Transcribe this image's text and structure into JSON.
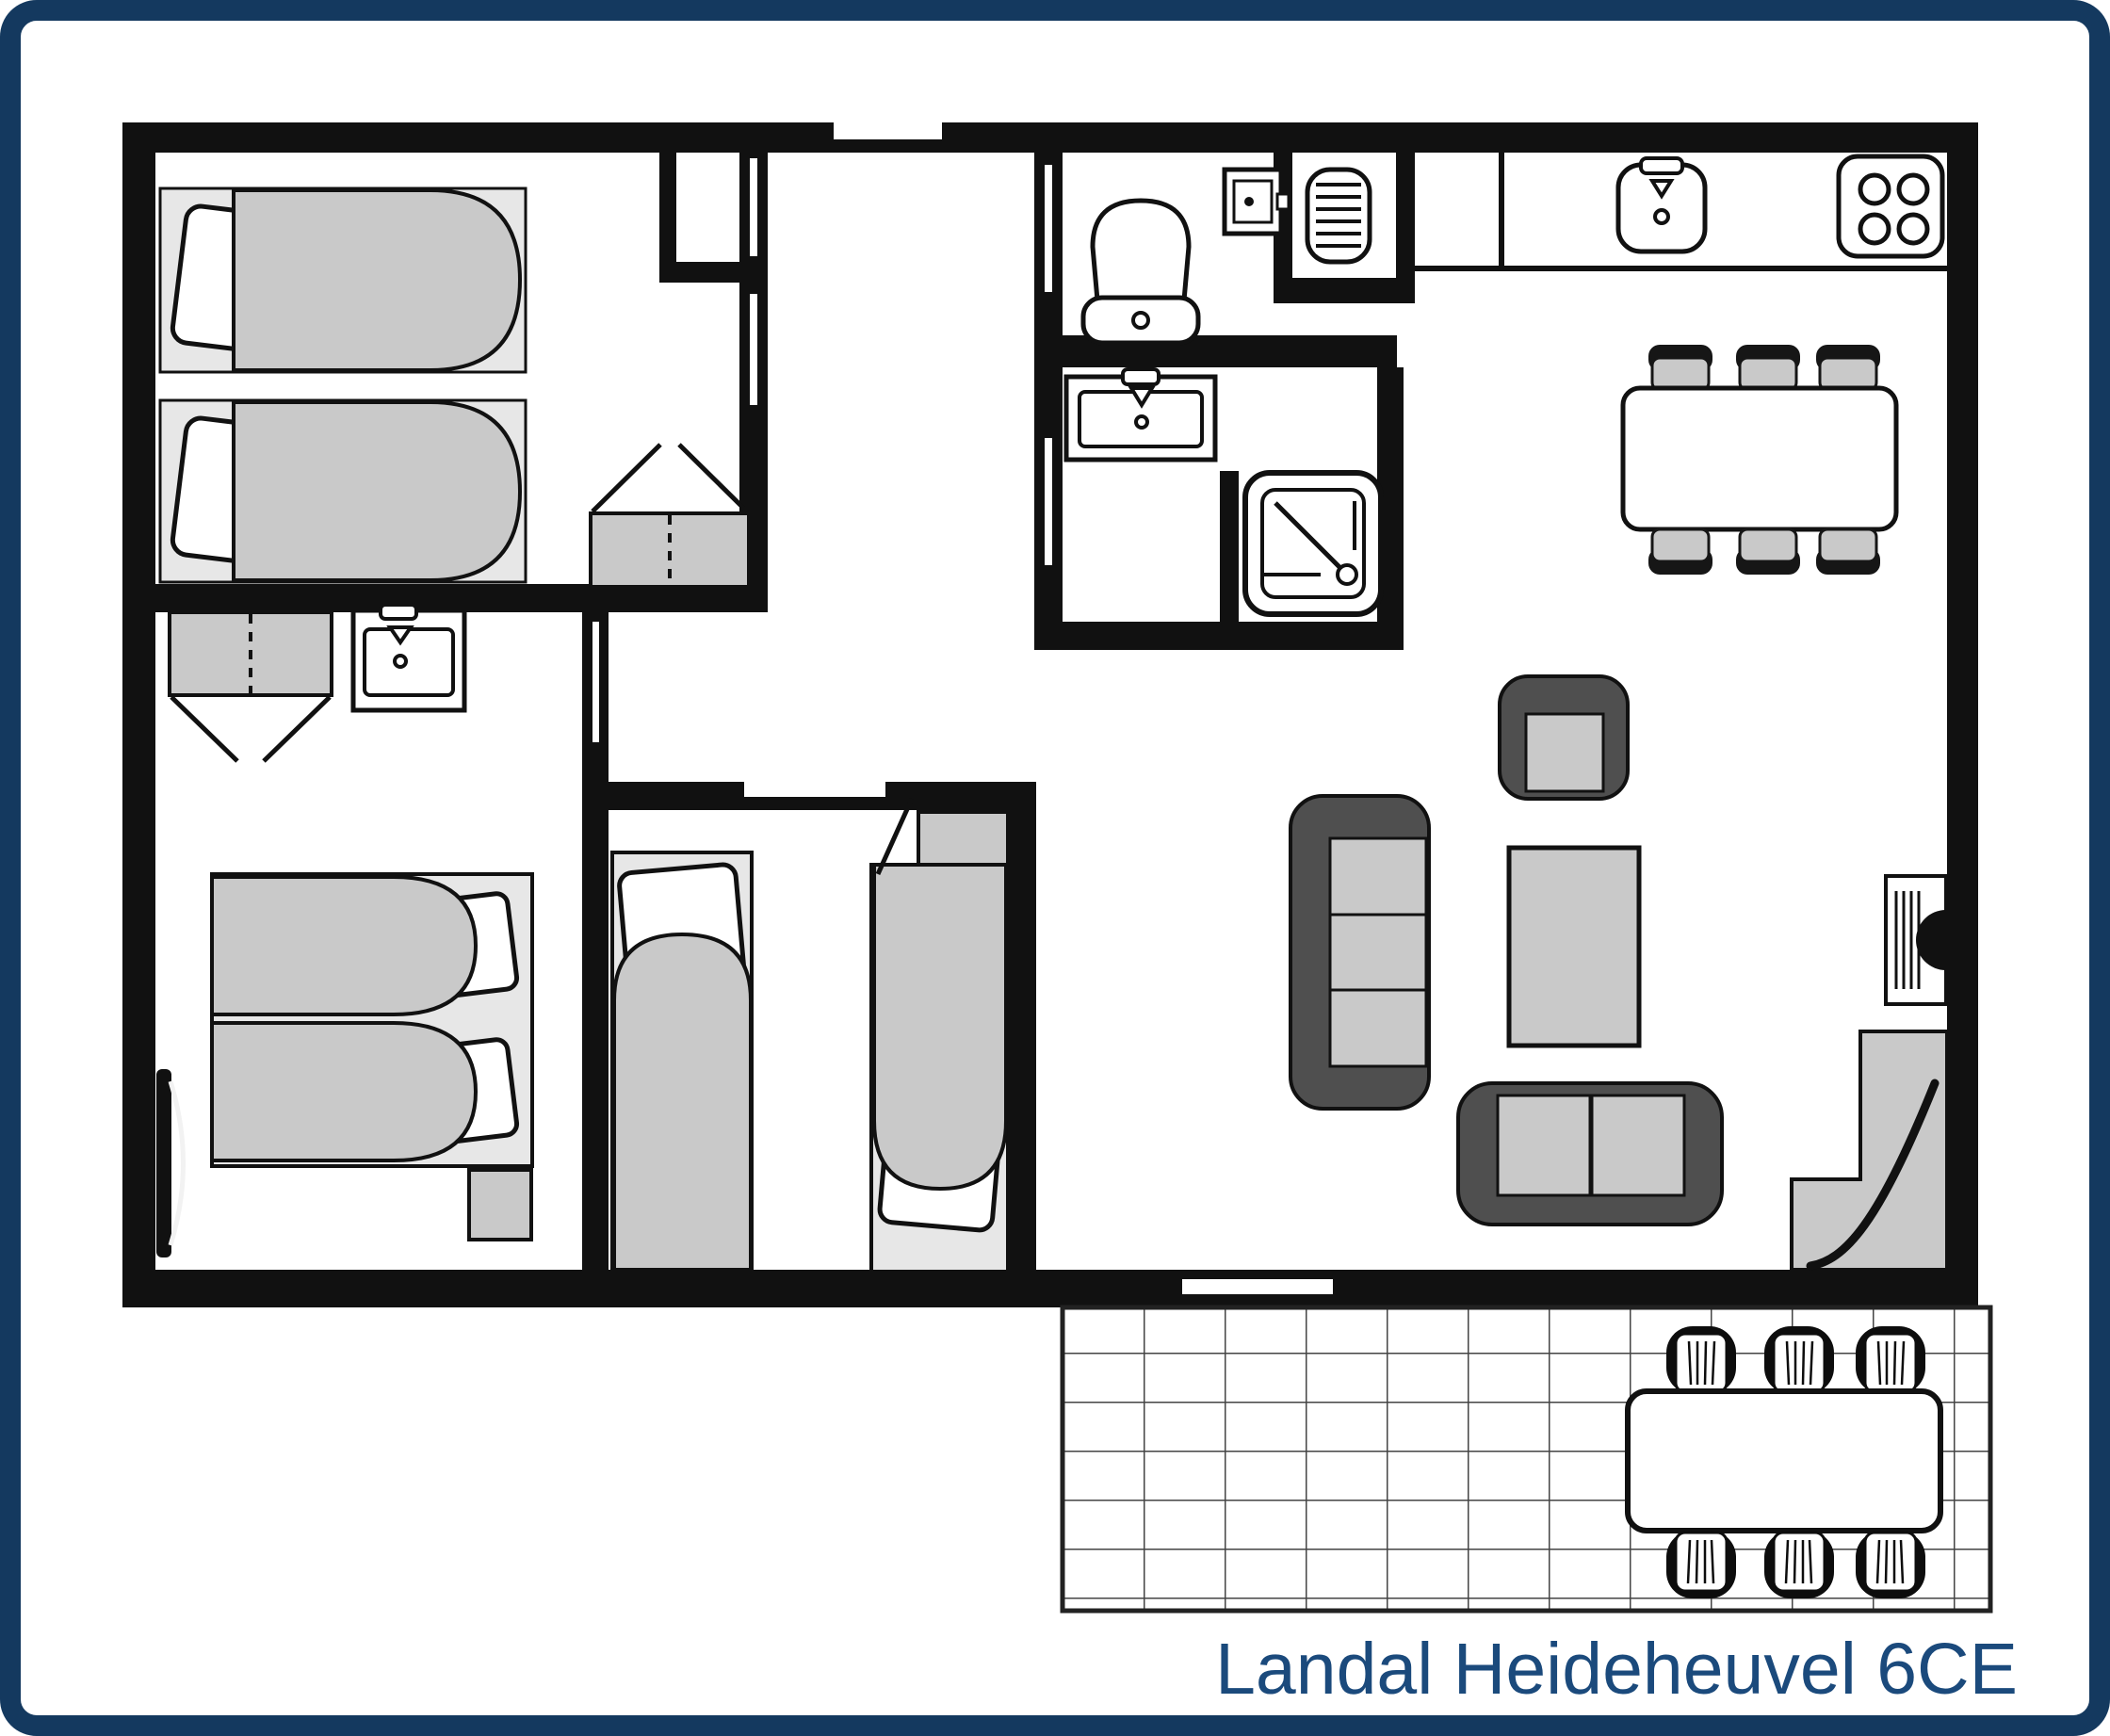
{
  "title": {
    "label": "Landal Heideheuvel 6CE"
  },
  "colors": {
    "frame_navy": "#14395f",
    "title_navy": "#1b4a7c",
    "wall_black": "#111111",
    "furniture_gray": "#c9c9c9",
    "furniture_light_gray": "#e7e7e7",
    "upholstery_dark_gray": "#4f4f4f",
    "background": "#ffffff"
  },
  "floorplan": {
    "type": "holiday-cottage-floor-plan",
    "rooms": [
      {
        "name": "bedroom-1",
        "fixtures": [
          "single-bed",
          "single-bed",
          "wardrobe",
          "hall-closet"
        ]
      },
      {
        "name": "bedroom-2",
        "fixtures": [
          "double-bed",
          "wardrobe",
          "washbasin",
          "radiator",
          "nightstand"
        ]
      },
      {
        "name": "bedroom-3",
        "fixtures": [
          "single-bed",
          "single-bed",
          "cabinet",
          "door"
        ]
      },
      {
        "name": "hallway",
        "fixtures": [
          "entrance-door-opening"
        ]
      },
      {
        "name": "toilet-room",
        "fixtures": [
          "toilet",
          "ventilation-box",
          "door"
        ]
      },
      {
        "name": "utility-niche",
        "fixtures": [
          "radiator"
        ]
      },
      {
        "name": "bathroom",
        "fixtures": [
          "washbasin",
          "shower",
          "door"
        ]
      },
      {
        "name": "kitchen",
        "fixtures": [
          "counter",
          "sink",
          "stove-4-burners"
        ]
      },
      {
        "name": "dining-area",
        "fixtures": [
          "dining-table",
          "dining-chair-x6"
        ]
      },
      {
        "name": "living-room",
        "fixtures": [
          "sofa-3-seat",
          "armchair",
          "coffee-table",
          "loveseat-2-seat",
          "fireplace",
          "corner-platform",
          "terrace-door-opening"
        ]
      },
      {
        "name": "terrace",
        "fixtures": [
          "tiled-floor",
          "garden-table",
          "garden-chair-x6"
        ]
      }
    ]
  }
}
